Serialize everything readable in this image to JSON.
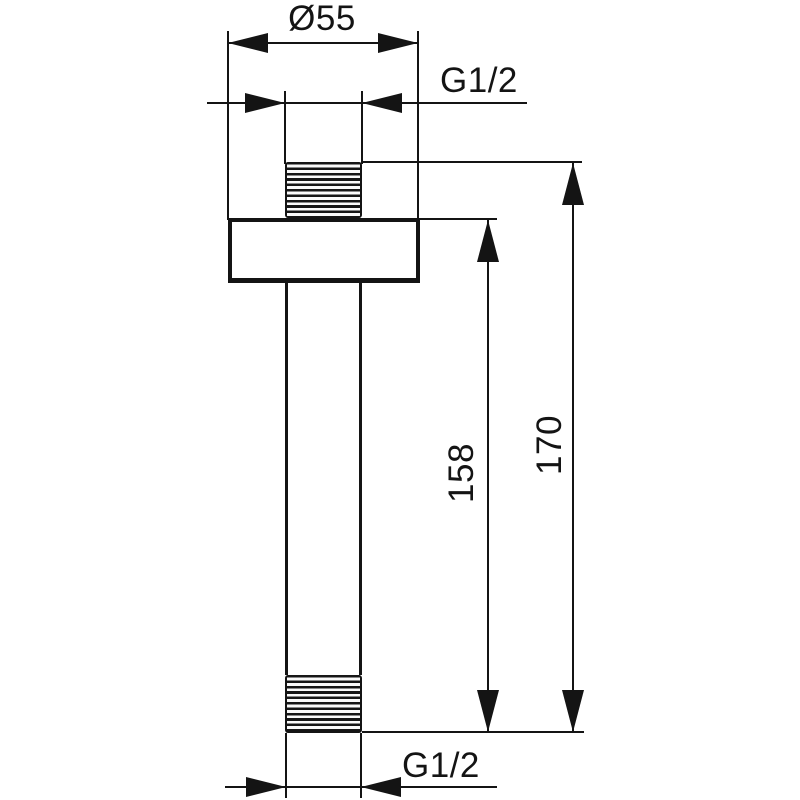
{
  "drawing": {
    "dimensions": {
      "flange_diameter": "Ø55",
      "thread_top": "G1/2",
      "length_from_flange": "158",
      "length_overall": "170",
      "thread_bottom": "G1/2"
    },
    "colors": {
      "line": "#141414",
      "background": "#ffffff"
    }
  }
}
